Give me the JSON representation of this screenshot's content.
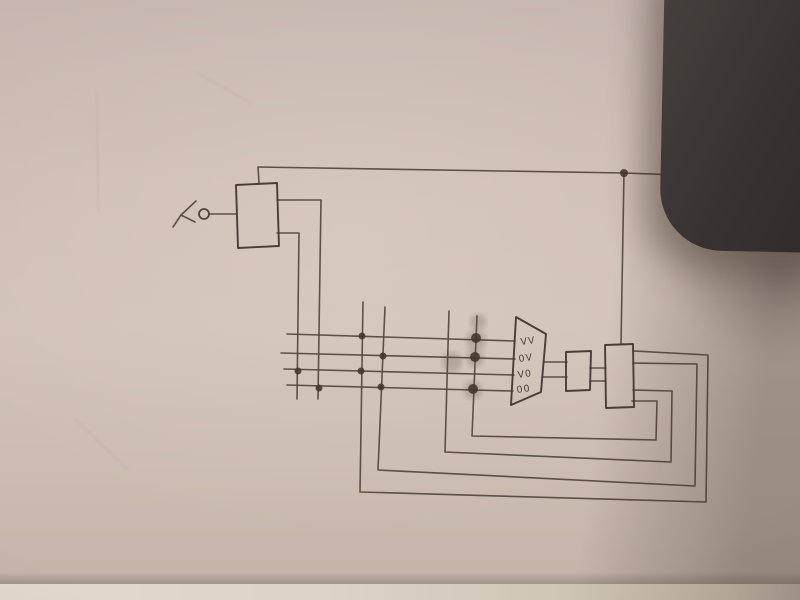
{
  "photo": {
    "paper_color": "#cbbab1",
    "object_color": "#3b3533",
    "pencil_color": "#51463f",
    "pencil_dark": "#41372f",
    "shadow_color": "rgba(62,50,44,0.33)"
  },
  "labels": {
    "input": "y",
    "output": "x",
    "mux_inputs": [
      "VV",
      "0V",
      "V0",
      "00"
    ]
  },
  "diagram": {
    "boxes": [
      {
        "name": "input-box",
        "pts": [
          [
            236,
            185
          ],
          [
            277,
            183
          ],
          [
            279,
            246
          ],
          [
            238,
            248
          ]
        ]
      },
      {
        "name": "mux-trapezoid",
        "pts": [
          [
            516,
            317
          ],
          [
            546,
            334
          ],
          [
            541,
            392
          ],
          [
            511,
            405
          ]
        ]
      },
      {
        "name": "middle-box",
        "pts": [
          [
            566,
            352
          ],
          [
            591,
            351
          ],
          [
            590,
            390
          ],
          [
            566,
            391
          ]
        ]
      },
      {
        "name": "state-box",
        "pts": [
          [
            605,
            345
          ],
          [
            633,
            344
          ],
          [
            634,
            407
          ],
          [
            606,
            408
          ]
        ]
      }
    ],
    "wires": [
      {
        "name": "input-wire",
        "pts": [
          [
            210,
            214
          ],
          [
            236,
            214
          ]
        ]
      },
      {
        "name": "top-output-wire",
        "pts": [
          [
            259,
            183
          ],
          [
            258,
            167
          ],
          [
            624,
            173
          ],
          [
            709,
            176
          ]
        ]
      },
      {
        "name": "junction-drop-wire",
        "pts": [
          [
            624,
            173
          ],
          [
            621,
            344
          ]
        ]
      },
      {
        "name": "box-output-wire-1",
        "pts": [
          [
            277,
            200
          ],
          [
            321,
            200
          ],
          [
            318,
            399
          ]
        ]
      },
      {
        "name": "box-output-wire-2",
        "pts": [
          [
            277,
            233
          ],
          [
            299,
            233
          ],
          [
            297,
            399
          ]
        ]
      },
      {
        "name": "bus-row-1",
        "pts": [
          [
            287,
            334
          ],
          [
            515,
            341
          ]
        ]
      },
      {
        "name": "bus-row-2",
        "pts": [
          [
            281,
            353
          ],
          [
            515,
            359
          ]
        ]
      },
      {
        "name": "bus-row-3",
        "pts": [
          [
            284,
            369
          ],
          [
            514,
            375
          ]
        ]
      },
      {
        "name": "bus-row-4",
        "pts": [
          [
            287,
            385
          ],
          [
            513,
            391
          ]
        ]
      },
      {
        "name": "feedback-loop-outer",
        "pts": [
          [
            363,
            302
          ],
          [
            360,
            492
          ],
          [
            706,
            502
          ],
          [
            708,
            355
          ],
          [
            633,
            351
          ]
        ]
      },
      {
        "name": "feedback-loop-2",
        "pts": [
          [
            385,
            307
          ],
          [
            378,
            470
          ],
          [
            695,
            486
          ],
          [
            697,
            364
          ],
          [
            633,
            363
          ]
        ]
      },
      {
        "name": "feedback-loop-3",
        "pts": [
          [
            449,
            311
          ],
          [
            445,
            452
          ],
          [
            671,
            462
          ],
          [
            672,
            391
          ],
          [
            633,
            390
          ]
        ]
      },
      {
        "name": "feedback-loop-inner",
        "pts": [
          [
            477,
            316
          ],
          [
            472,
            436
          ],
          [
            656,
            440
          ],
          [
            657,
            401
          ],
          [
            632,
            401
          ]
        ]
      },
      {
        "name": "mux-output-wire-1",
        "pts": [
          [
            544,
            362
          ],
          [
            567,
            362
          ]
        ]
      },
      {
        "name": "mux-output-wire-2",
        "pts": [
          [
            542,
            377
          ],
          [
            567,
            377
          ]
        ]
      },
      {
        "name": "middle-link-wire-1",
        "pts": [
          [
            590,
            368
          ],
          [
            606,
            368
          ]
        ]
      },
      {
        "name": "middle-link-wire-2",
        "pts": [
          [
            590,
            381
          ],
          [
            606,
            381
          ]
        ]
      },
      {
        "name": "input-label-stroke-1",
        "pts": [
          [
            196,
            201
          ],
          [
            181,
            215
          ],
          [
            173,
            227
          ]
        ]
      },
      {
        "name": "input-label-stroke-2",
        "pts": [
          [
            181,
            215
          ],
          [
            195,
            222
          ]
        ]
      },
      {
        "name": "output-label-stroke-1",
        "pts": [
          [
            724,
            171
          ],
          [
            740,
            187
          ]
        ]
      },
      {
        "name": "output-label-stroke-2",
        "pts": [
          [
            738,
            172
          ],
          [
            726,
            188
          ]
        ]
      }
    ],
    "junction_dots": [
      {
        "name": "junction-colA-row3",
        "x": 298,
        "y": 371,
        "r": 3.5
      },
      {
        "name": "junction-colB-row4",
        "x": 319,
        "y": 388,
        "r": 3.5
      },
      {
        "name": "junction-colC-row1",
        "x": 362,
        "y": 336,
        "r": 3.5
      },
      {
        "name": "junction-colC-row3",
        "x": 361,
        "y": 371,
        "r": 3.5
      },
      {
        "name": "junction-colD-row2",
        "x": 383,
        "y": 356,
        "r": 3.5
      },
      {
        "name": "junction-colD-row4",
        "x": 381,
        "y": 387,
        "r": 3.5
      },
      {
        "name": "junction-colF-row1",
        "x": 476,
        "y": 338,
        "r": 5
      },
      {
        "name": "junction-colF-row2",
        "x": 475,
        "y": 357,
        "r": 5
      },
      {
        "name": "junction-colF-row4",
        "x": 473,
        "y": 389,
        "r": 5
      },
      {
        "name": "junction-top-node",
        "x": 624,
        "y": 173,
        "r": 4
      }
    ],
    "smudges": [
      {
        "x": 478,
        "y": 322,
        "r": 8
      },
      {
        "x": 476,
        "y": 340,
        "r": 10
      },
      {
        "x": 475,
        "y": 358,
        "r": 9
      },
      {
        "x": 473,
        "y": 390,
        "r": 9
      },
      {
        "x": 452,
        "y": 362,
        "r": 10
      }
    ],
    "terminals": [
      {
        "name": "input-terminal",
        "x": 204,
        "y": 214,
        "r": 5
      },
      {
        "name": "output-terminal",
        "x": 712,
        "y": 176,
        "r": 4
      }
    ],
    "mux_label_positions": [
      {
        "x": 521,
        "y": 345
      },
      {
        "x": 519,
        "y": 362
      },
      {
        "x": 518,
        "y": 378
      },
      {
        "x": 517,
        "y": 393
      }
    ],
    "creases": [
      {
        "pts": [
          [
            96,
            92
          ],
          [
            99,
            212
          ]
        ]
      },
      {
        "pts": [
          [
            74,
            418
          ],
          [
            128,
            470
          ]
        ]
      },
      {
        "pts": [
          [
            196,
            72
          ],
          [
            252,
            104
          ]
        ]
      }
    ]
  }
}
